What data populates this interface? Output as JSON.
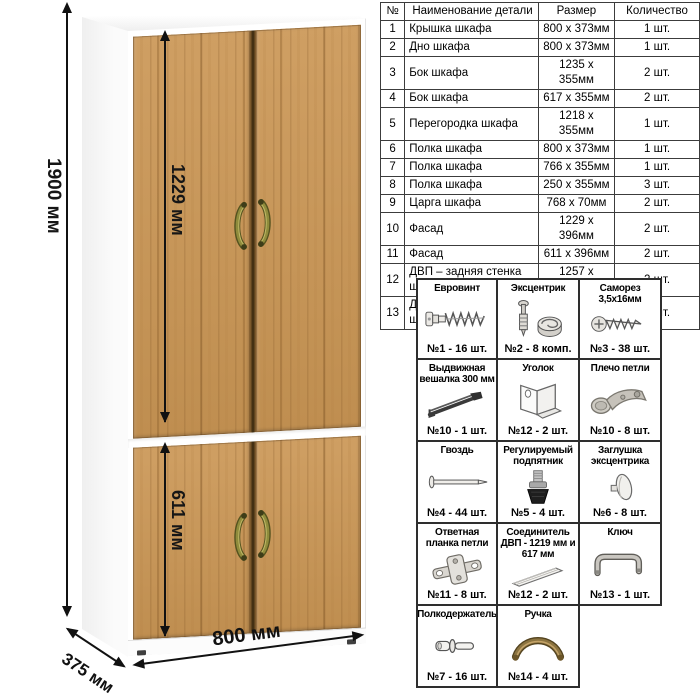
{
  "scheme": {
    "dims": {
      "height": "1900 мм",
      "top_section": "1229 мм",
      "bottom_section": "611 мм",
      "width": "800 мм",
      "depth": "375 мм"
    },
    "colors": {
      "door_wood": "#c79757",
      "door_grain": "#8a5f2d",
      "carcass_white": "#ffffff",
      "handle_olive": "#7d7c33",
      "dimension_line": "#111111"
    }
  },
  "parts_table": {
    "headers": {
      "num": "№",
      "name": "Наименование детали",
      "size": "Размер",
      "qty": "Количество"
    },
    "rows": [
      {
        "num": "1",
        "name": "Крышка шкафа",
        "size": "800 x 373мм",
        "qty": "1 шт."
      },
      {
        "num": "2",
        "name": "Дно шкафа",
        "size": "800 x 373мм",
        "qty": "1 шт."
      },
      {
        "num": "3",
        "name": "Бок шкафа",
        "size": "1235 x 355мм",
        "qty": "2 шт."
      },
      {
        "num": "4",
        "name": "Бок шкафа",
        "size": "617 x 355мм",
        "qty": "2 шт."
      },
      {
        "num": "5",
        "name": "Перегородка шкафа",
        "size": "1218 x 355мм",
        "qty": "1 шт."
      },
      {
        "num": "6",
        "name": "Полка шкафа",
        "size": "800 x 373мм",
        "qty": "1 шт."
      },
      {
        "num": "7",
        "name": "Полка шкафа",
        "size": "766 x 355мм",
        "qty": "1 шт."
      },
      {
        "num": "8",
        "name": "Полка шкафа",
        "size": "250 x 355мм",
        "qty": "3 шт."
      },
      {
        "num": "9",
        "name": "Царга шкафа",
        "size": "768 x 70мм",
        "qty": "2 шт."
      },
      {
        "num": "10",
        "name": "Фасад",
        "size": "1229 x 396мм",
        "qty": "2 шт."
      },
      {
        "num": "11",
        "name": "Фасад",
        "size": "611 x 396мм",
        "qty": "2 шт."
      },
      {
        "num": "12",
        "name": "ДВП – задняя стенка шкафа",
        "size": "1257 x 396мм",
        "qty": "2 шт."
      },
      {
        "num": "13",
        "name": "ДВП – задняя стенка шкафа",
        "size": "639 x 396мм",
        "qty": "2 шт."
      }
    ]
  },
  "hardware": {
    "items": [
      {
        "title": "Евровинт",
        "qty": "№1 - 16 шт.",
        "icon": "euro-screw"
      },
      {
        "title": "Эксцентрик",
        "qty": "№2 - 8 комп.",
        "icon": "eccentric-cam"
      },
      {
        "title": "Саморез 3,5х16мм",
        "qty": "№3 - 38 шт.",
        "icon": "self-tapping-screw"
      },
      {
        "title": "Выдвижная вешалка 300 мм",
        "qty": "№10 - 1 шт.",
        "icon": "pullout-hanger"
      },
      {
        "title": "Уголок",
        "qty": "№12 - 2 шт.",
        "icon": "corner-bracket"
      },
      {
        "title": "Плечо петли",
        "qty": "№10 - 8 шт.",
        "icon": "hinge-arm"
      },
      {
        "title": "Гвоздь",
        "qty": "№4 - 44 шт.",
        "icon": "nail"
      },
      {
        "title": "Регулируемый подпятник",
        "qty": "№5 - 4 шт.",
        "icon": "adjustable-foot"
      },
      {
        "title": "Заглушка эксцентрика",
        "qty": "№6 - 8 шт.",
        "icon": "cam-cap"
      },
      {
        "title": "Ответная планка петли",
        "qty": "№11 - 8 шт.",
        "icon": "hinge-plate"
      },
      {
        "title": "Соединитель ДВП - 1219 мм и 617 мм",
        "qty": "№12 - 2 шт.",
        "icon": "hdf-connector"
      },
      {
        "title": "Ключ",
        "qty": "№13 - 1 шт.",
        "icon": "hex-key"
      },
      {
        "title": "Полкодержатель",
        "qty": "№7 - 16 шт.",
        "icon": "shelf-pin"
      },
      {
        "title": "Ручка",
        "qty": "№14 - 4 шт.",
        "icon": "handle"
      }
    ]
  }
}
